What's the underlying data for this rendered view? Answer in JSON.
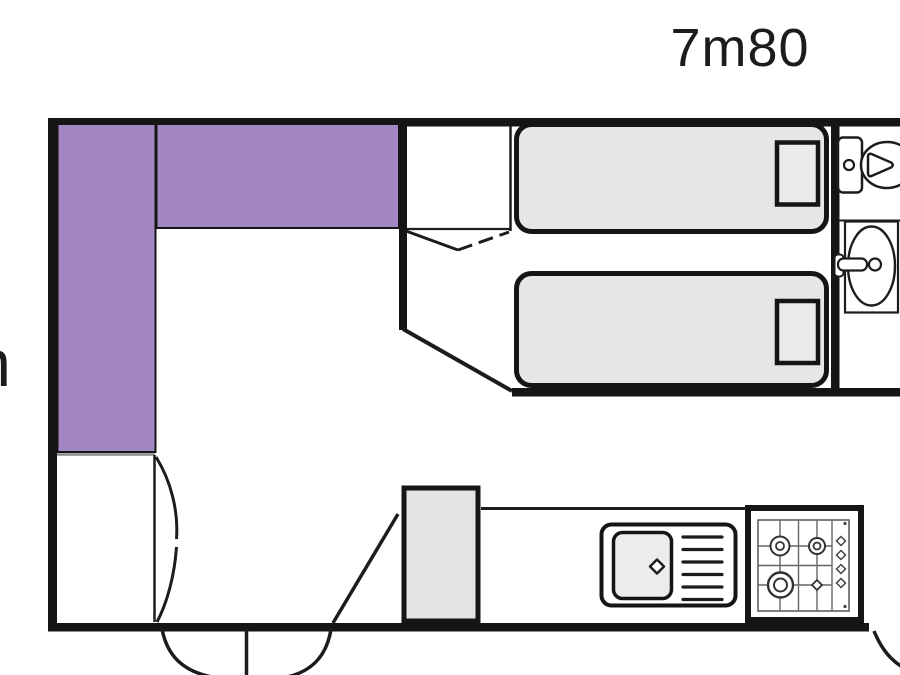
{
  "labels": {
    "length_dimension": "7m80",
    "left_edge_dimension_fragment": "m"
  },
  "colors": {
    "wall": "#151515",
    "line": "#1c1c1c",
    "seat_purple": "#a287c3",
    "bed_gray": "#e6e6e6",
    "pillow_gray": "#ebebeb",
    "fridge_gray": "#e4e4e4",
    "basin_gray": "#ececec",
    "background": "#ffffff"
  },
  "floorplan": {
    "type": "mobile-home-floor-plan",
    "rooms": [
      "living-dining-area",
      "twin-bedroom",
      "bathroom",
      "kitchen"
    ],
    "items": [
      "l-shaped-lounge-seat",
      "wardrobe",
      "single-bed-1",
      "single-bed-2",
      "toilet",
      "washbasin",
      "fridge",
      "kitchen-sink-unit",
      "gas-hob",
      "entrance-double-door",
      "bedroom-door",
      "bathroom-door",
      "left-closet"
    ]
  }
}
